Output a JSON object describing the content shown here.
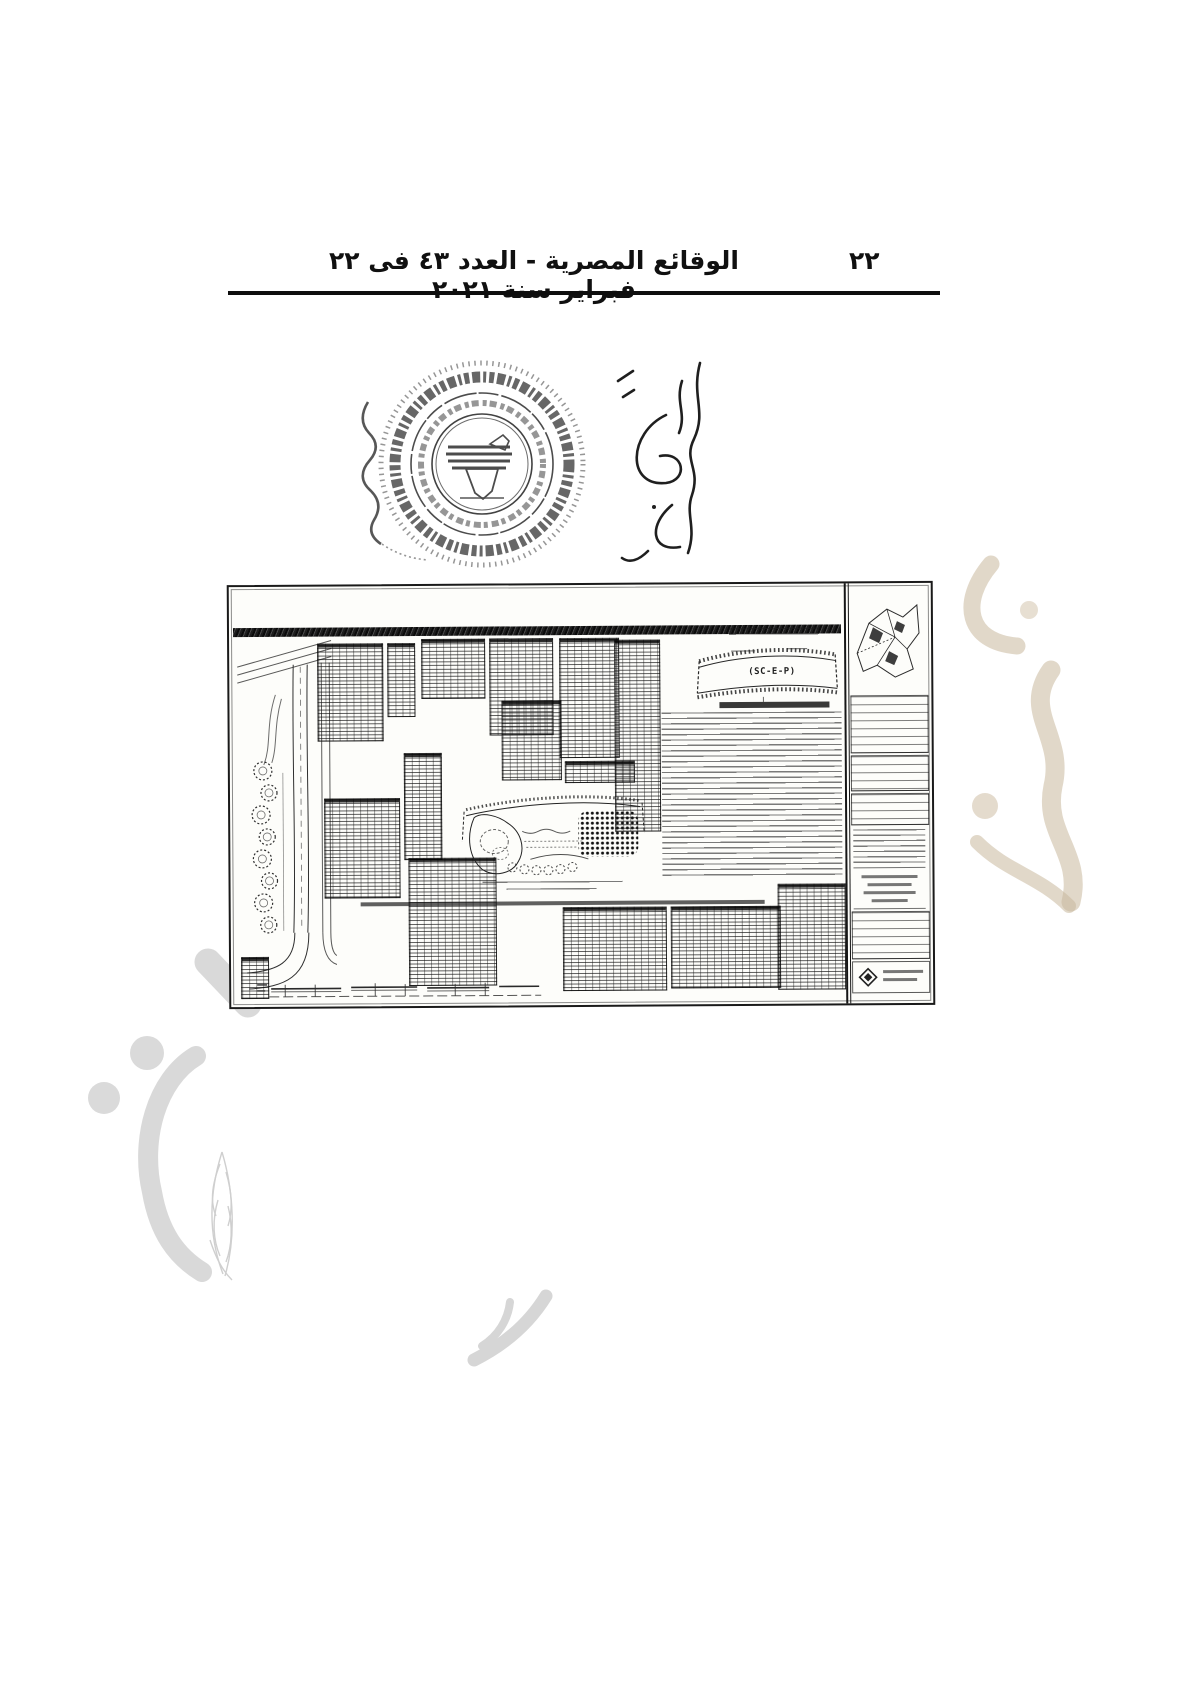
{
  "header": {
    "gazette_title": "الوقائع المصرية - العدد ٤٣ فى ٢٢ فبراير سنة ٢٠٢١",
    "page_number": "٢٢"
  },
  "map_sheet": {
    "plot_label": "(SC-E-P)"
  },
  "icons": {
    "official_round_stamp": "egypt-eagle-round-seal",
    "signature": "handwritten-arabic-signature",
    "watermark_left": "gazette-emblem-gray-watermark",
    "watermark_right": "arabic-calligraphy-tan-watermark",
    "watermark_bottom": "calligraphy-flourish-gray-watermark",
    "title_block_logo": "diamond-architect-logo"
  },
  "colors": {
    "ink": "#1a1a1a",
    "watermark_gray": "#d8d8d8",
    "watermark_tan": "#c9b89c"
  }
}
